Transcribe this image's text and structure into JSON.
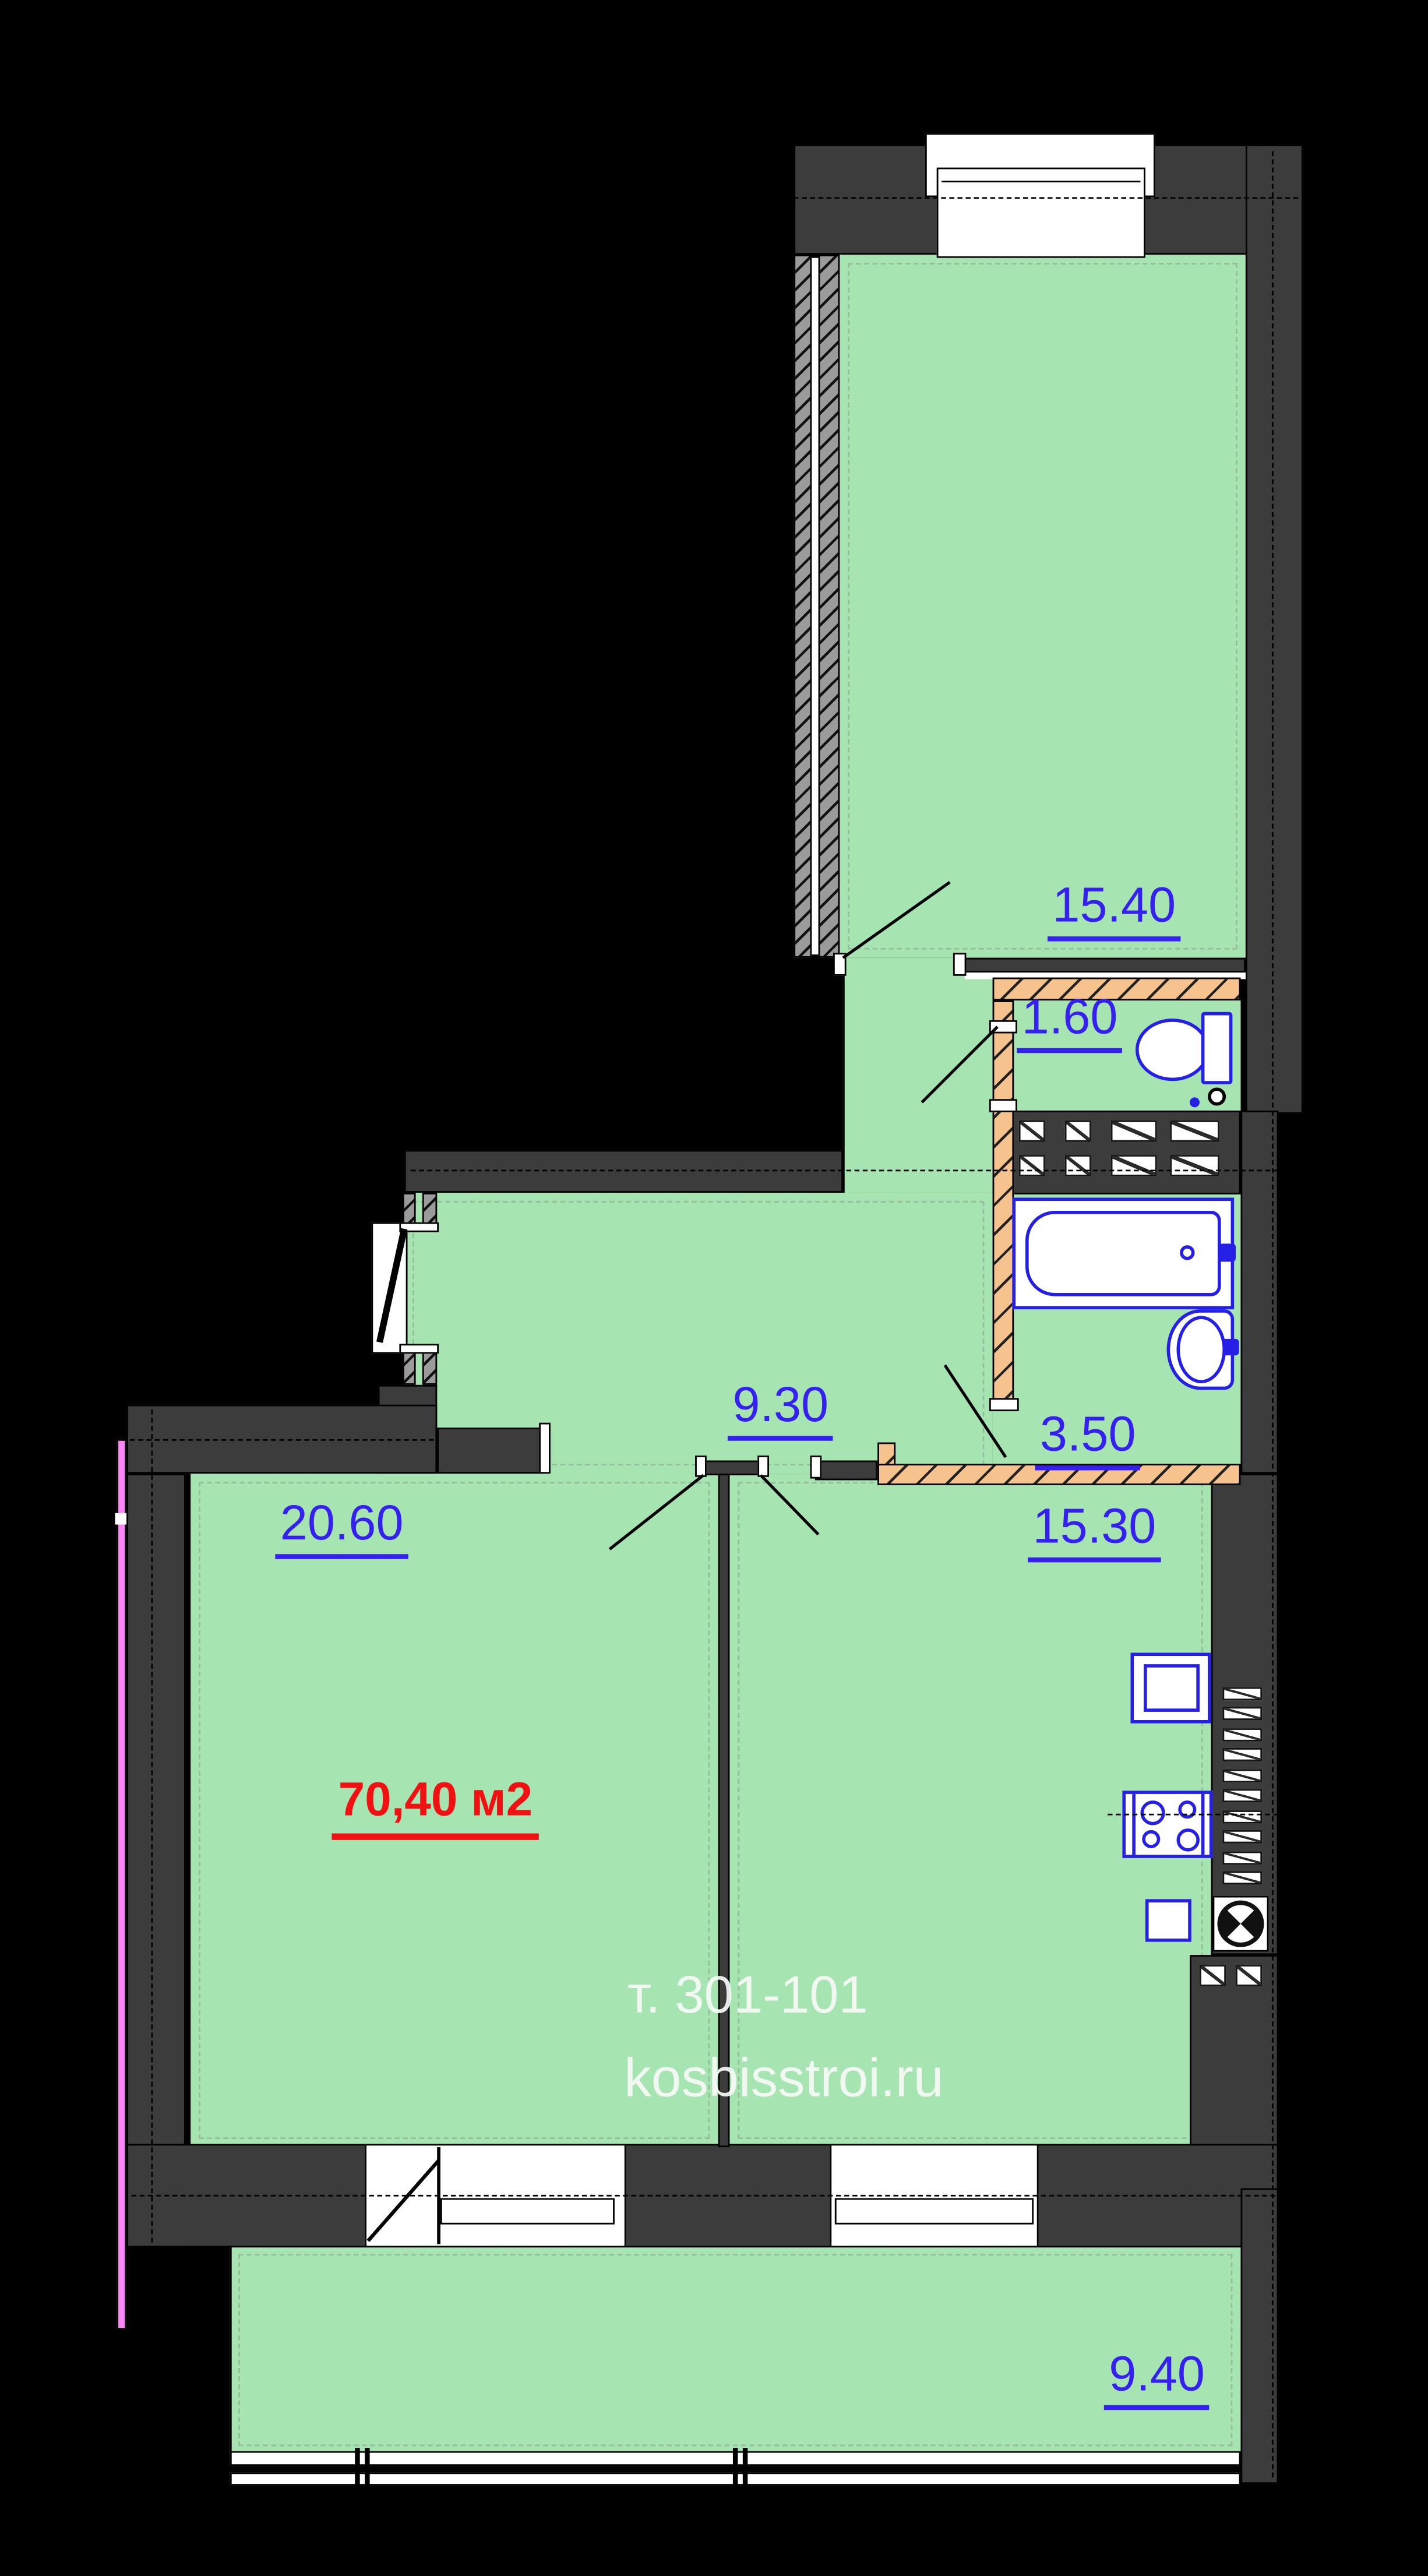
{
  "rooms": [
    {
      "name": "bedroom",
      "area": "15.40"
    },
    {
      "name": "wc",
      "area": "1.60"
    },
    {
      "name": "hall",
      "area": "9.30"
    },
    {
      "name": "bathroom",
      "area": "3.50"
    },
    {
      "name": "living-room",
      "area": "20.60"
    },
    {
      "name": "kitchen",
      "area": "15.30"
    },
    {
      "name": "balcony",
      "area": "9.40"
    }
  ],
  "total_area": "70,40 м2",
  "watermark": {
    "phone": "т. 301-101",
    "website": "kosbisstroi.ru"
  },
  "fixtures": [
    "toilet",
    "bathtub",
    "wash-basin",
    "kitchen-sink",
    "stove-4-burner",
    "ventilation-shaft"
  ],
  "colors": {
    "floor_green": "#a6e5b2",
    "wall_dark": "#3c3c3c",
    "fixture_blue": "#2620e6",
    "label_blue": "#3520f0",
    "partition_orange": "#f6c38e",
    "total_red": "#f01212",
    "insulation_pink": "#fd85f6",
    "background": "#000000"
  }
}
